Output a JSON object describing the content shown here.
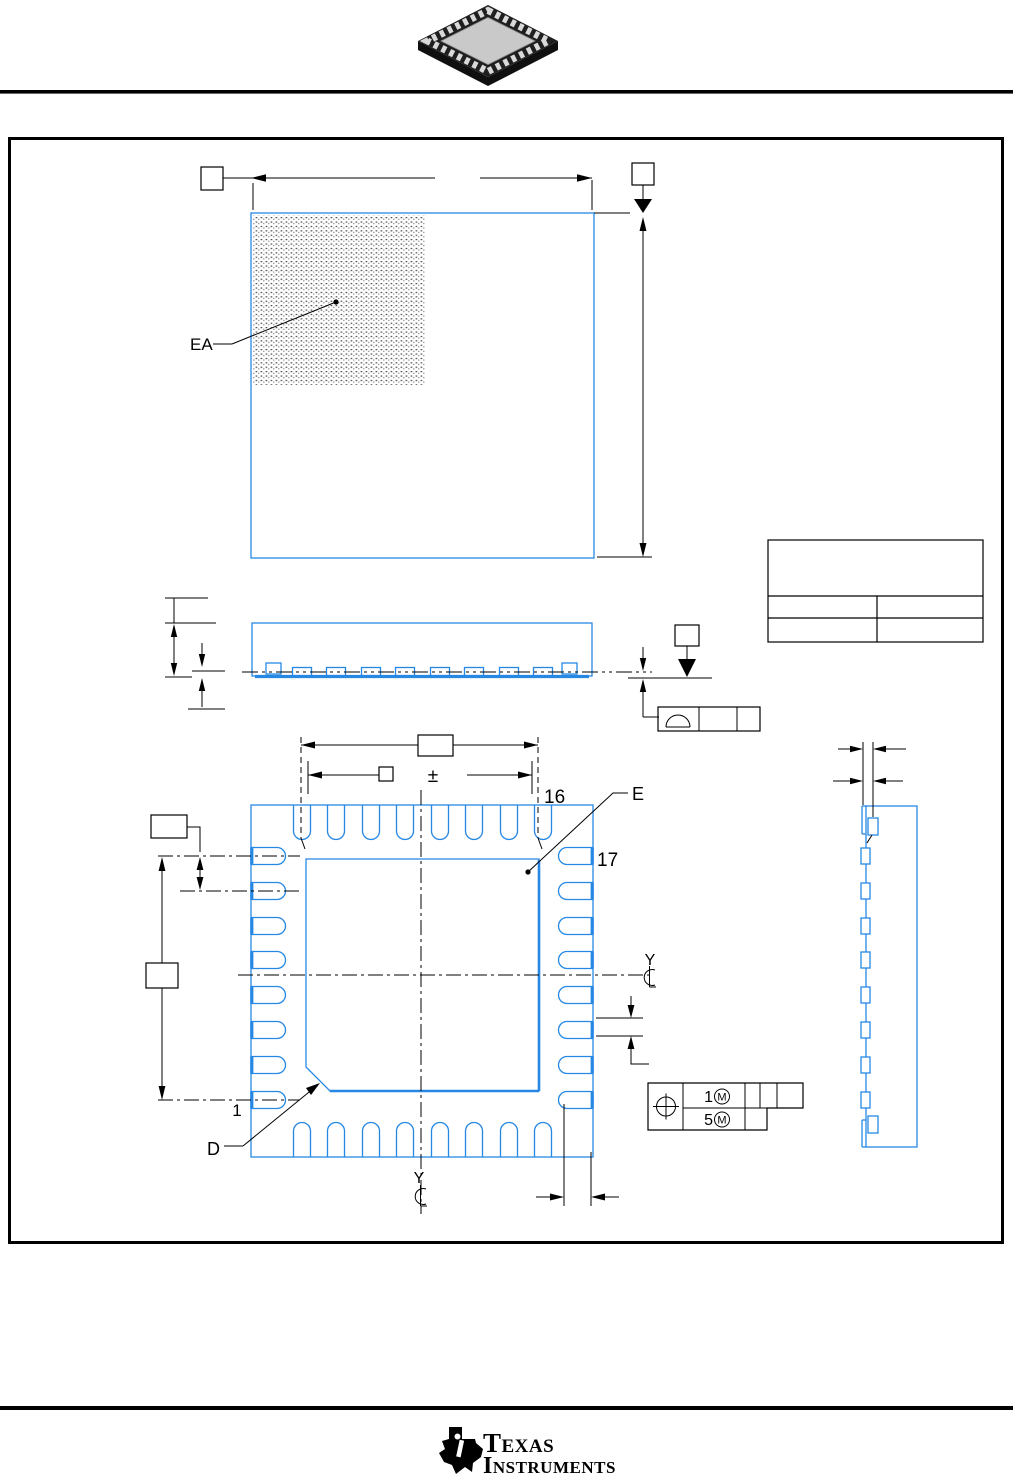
{
  "colors": {
    "line_blue": "#2688e3",
    "line_black": "#000000",
    "page_bg": "#ffffff"
  },
  "top_view": {
    "thermal_pad_label": "EA"
  },
  "bottom_view": {
    "pin16_label": "16",
    "pin17_label": "17",
    "pin1_label": "1",
    "lead_dim_label": "E",
    "pad_dim_label": "D",
    "datum_y_right_label": "Y",
    "datum_y_bottom_label": "Y",
    "tolerance_sign": "±"
  },
  "gdt_frame": {
    "row1_value": "1",
    "row2_value": "5",
    "modifier_letter": "M"
  },
  "logo": {
    "word1": "Texas",
    "word2": "Instruments"
  }
}
